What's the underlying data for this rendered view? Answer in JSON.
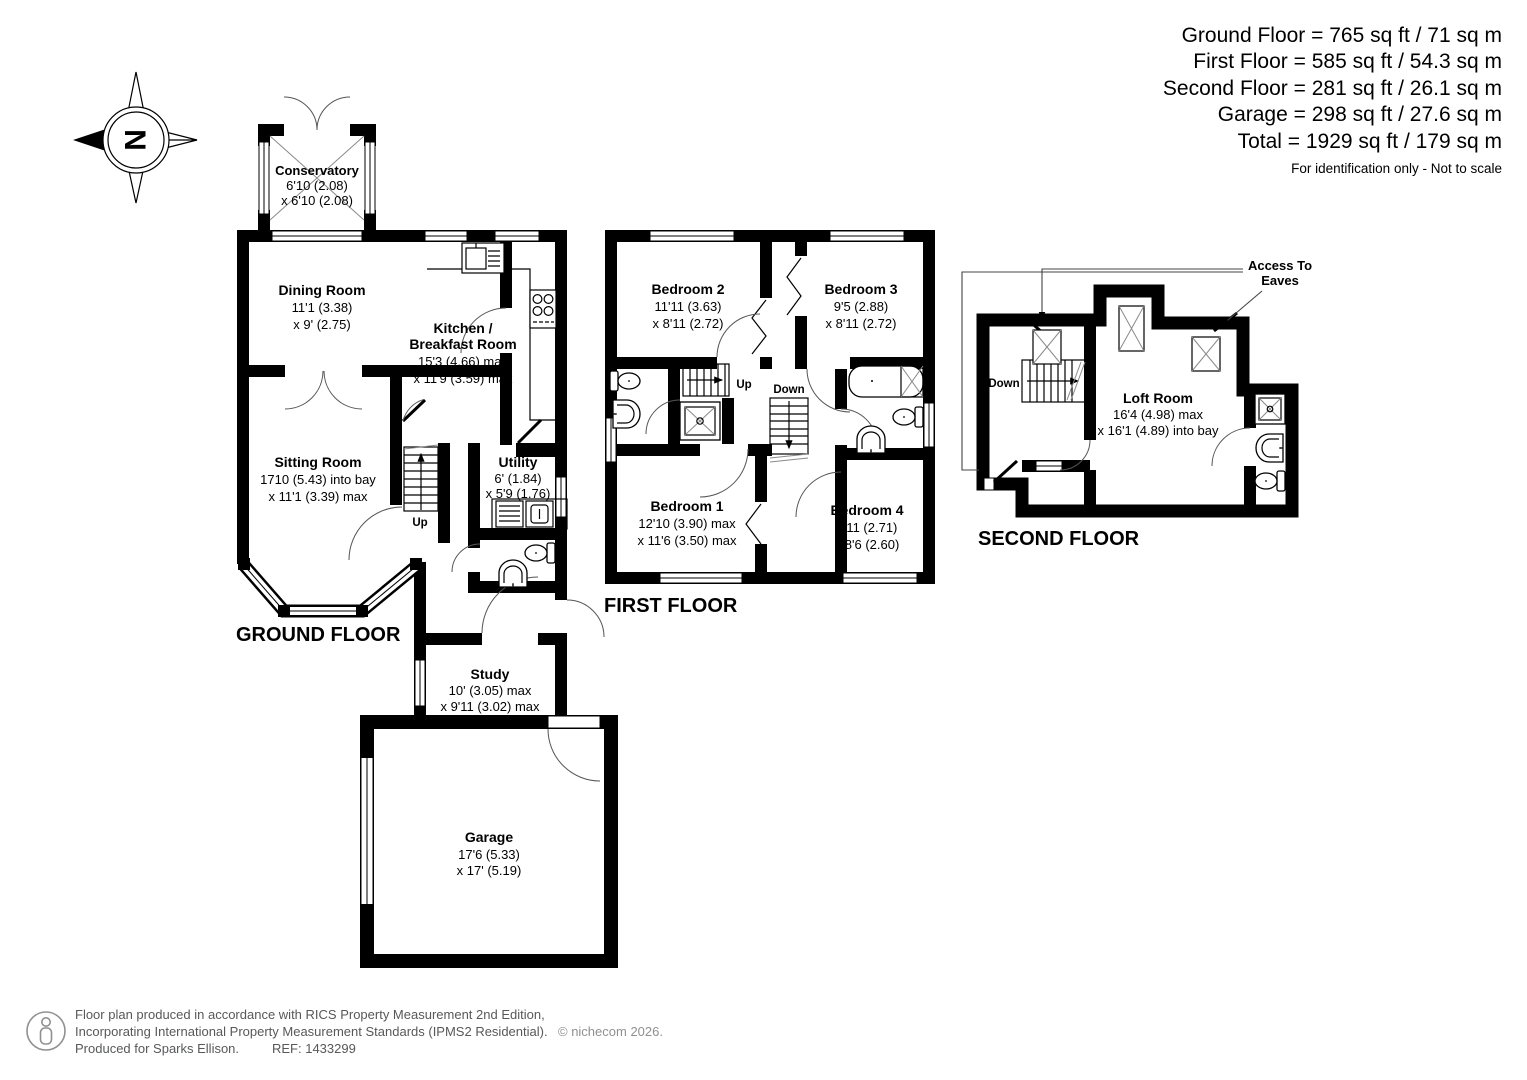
{
  "summary": {
    "lines": [
      "Ground Floor = 765 sq ft / 71 sq m",
      "First Floor = 585 sq ft / 54.3 sq m",
      "Second Floor = 281 sq ft / 26.1 sq m",
      "Garage = 298 sq ft / 27.6 sq m",
      "Total = 1929 sq ft / 179 sq m"
    ],
    "note": "For identification only - Not to scale"
  },
  "compass": {
    "letter": "N"
  },
  "floors": {
    "ground": {
      "title": "GROUND FLOOR"
    },
    "first": {
      "title": "FIRST FLOOR"
    },
    "second": {
      "title": "SECOND FLOOR"
    }
  },
  "rooms": {
    "conservatory": {
      "name": "Conservatory",
      "dim1": "6'10 (2.08)",
      "dim2": "x 6'10 (2.08)"
    },
    "dining": {
      "name": "Dining Room",
      "dim1": "11'1 (3.38)",
      "dim2": "x 9' (2.75)"
    },
    "kitchen": {
      "name1": "Kitchen /",
      "name2": "Breakfast Room",
      "dim1": "15'3 (4.66) max",
      "dim2": "x 11'9 (3.59) max"
    },
    "sitting": {
      "name": "Sitting Room",
      "dim1": "1710 (5.43) into bay",
      "dim2": "x 11'1 (3.39) max"
    },
    "utility": {
      "name": "Utility",
      "dim1": "6' (1.84)",
      "dim2": "x 5'9 (1.76)"
    },
    "study": {
      "name": "Study",
      "dim1": "10' (3.05) max",
      "dim2": "x 9'11 (3.02) max"
    },
    "garage": {
      "name": "Garage",
      "dim1": "17'6 (5.33)",
      "dim2": "x 17' (5.19)"
    },
    "bedroom1": {
      "name": "Bedroom 1",
      "dim1": "12'10 (3.90) max",
      "dim2": "x 11'6 (3.50) max"
    },
    "bedroom2": {
      "name": "Bedroom 2",
      "dim1": "11'11 (3.63)",
      "dim2": "x 8'11 (2.72)"
    },
    "bedroom3": {
      "name": "Bedroom 3",
      "dim1": "9'5 (2.88)",
      "dim2": "x 8'11 (2.72)"
    },
    "bedroom4": {
      "name": "Bedroom 4",
      "dim1": "8'11 (2.71)",
      "dim2": "x 8'6 (2.60)"
    },
    "loft": {
      "name": "Loft Room",
      "dim1": "16'4 (4.98) max",
      "dim2": "x 16'1 (4.89) into bay"
    }
  },
  "stairs": {
    "up": "Up",
    "down": "Down"
  },
  "annotations": {
    "access1": "Access To",
    "access2": "Eaves"
  },
  "footer": {
    "line1": "Floor plan produced in accordance with RICS Property Measurement 2nd Edition,",
    "line2": "Incorporating International Property Measurement Standards (IPMS2 Residential).",
    "copyright": "© nichecom 2026.",
    "line3": "Produced for Sparks Ellison.",
    "ref": "REF: 1433299"
  }
}
